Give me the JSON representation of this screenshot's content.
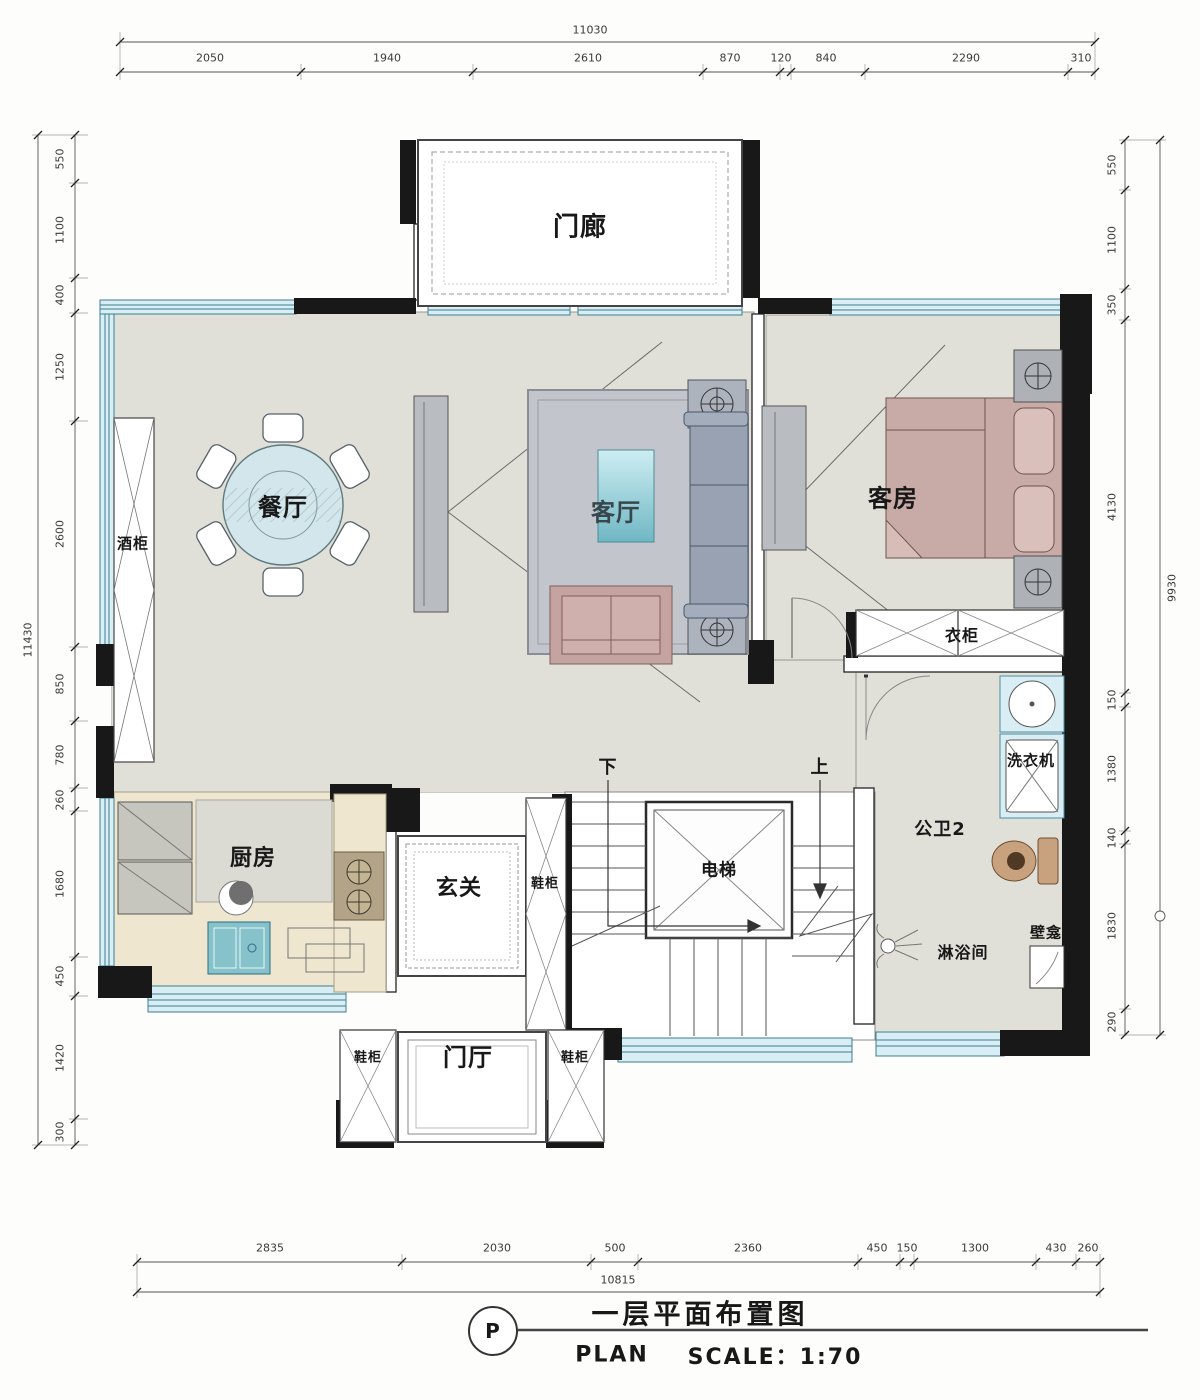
{
  "drawing": {
    "type": "floor-plan",
    "colors": {
      "wall": "#181818",
      "window": "#d8eef4",
      "window_frame": "#3d7f90",
      "floor_main": "#e1e0d8",
      "floor_kitchen": "#eee6cf",
      "sofa_gray": "#98a2b2",
      "bed_pink": "#c8aaa6",
      "table_teal": "#7bbcc9",
      "toilet_tan": "#c8a17e"
    }
  },
  "dims": {
    "top": {
      "total": "11030",
      "segments": [
        "2050",
        "1940",
        "2610",
        "870",
        "120",
        "840",
        "2290",
        "310"
      ]
    },
    "left": {
      "total": "11430",
      "segments": [
        "550",
        "1100",
        "400",
        "1250",
        "2600",
        "850",
        "780",
        "260",
        "1680",
        "450",
        "1420",
        "300"
      ]
    },
    "right": {
      "total": "9930",
      "segments": [
        "550",
        "1100",
        "350",
        "4130",
        "150",
        "1380",
        "140",
        "1830",
        "290"
      ]
    },
    "bottom": {
      "total": "10815",
      "segments": [
        "2835",
        "2030",
        "500",
        "2360",
        "450",
        "150",
        "1300",
        "430",
        "260"
      ]
    }
  },
  "rooms": {
    "porch": "门廊",
    "dining": "餐厅",
    "living": "客厅",
    "guest": "客房",
    "kitchen": "厨房",
    "entry": "玄关",
    "foyer": "门厅",
    "elevator": "电梯",
    "bath2": "公卫2",
    "shower": "淋浴间",
    "wardrobe": "衣柜",
    "wine_cabinet": "酒柜",
    "washer": "洗衣机",
    "niche": "壁龛",
    "shoe_cabinet": "鞋柜",
    "stair_up": "上",
    "stair_down": "下"
  },
  "title": {
    "bubble": "P",
    "cn": "一层平面布置图",
    "en": "PLAN",
    "scale": "SCALE：1:70"
  }
}
